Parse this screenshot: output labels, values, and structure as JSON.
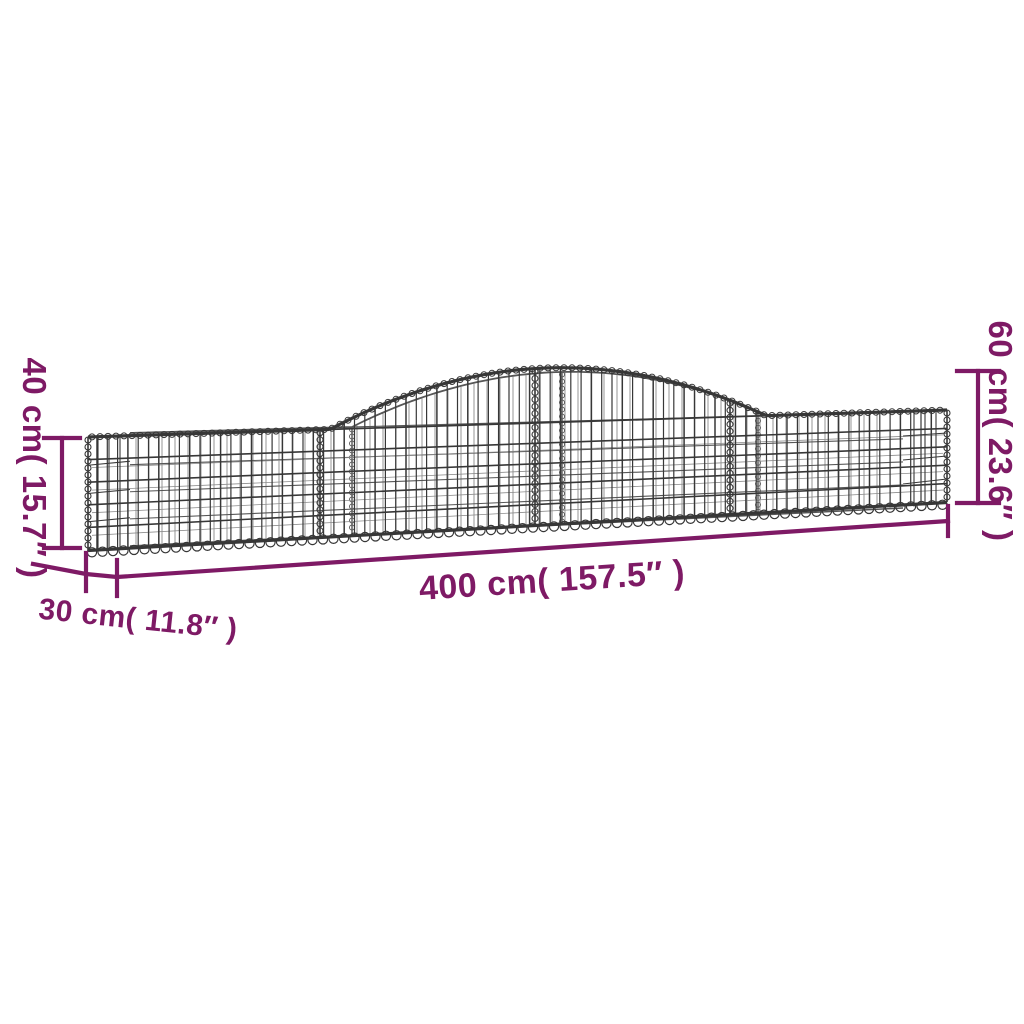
{
  "colors": {
    "background": "#ffffff",
    "dimension": "#7e1a65",
    "wire_dark": "#373737",
    "wire_mid": "#565656",
    "wire_light": "#8b8b8b"
  },
  "dimensions": {
    "length": {
      "label": "400 cm( 157.5″ )",
      "metric": "400 cm",
      "imperial": "157.5″"
    },
    "depth": {
      "label": "30 cm( 11.8″ )",
      "metric": "30 cm",
      "imperial": "11.8″"
    },
    "end_height": {
      "label": "40 cm( 15.7″ )",
      "metric": "40 cm",
      "imperial": "15.7″"
    },
    "peak_height": {
      "label": "60 cm( 23.6″ )",
      "metric": "60 cm",
      "imperial": "23.6″"
    }
  }
}
